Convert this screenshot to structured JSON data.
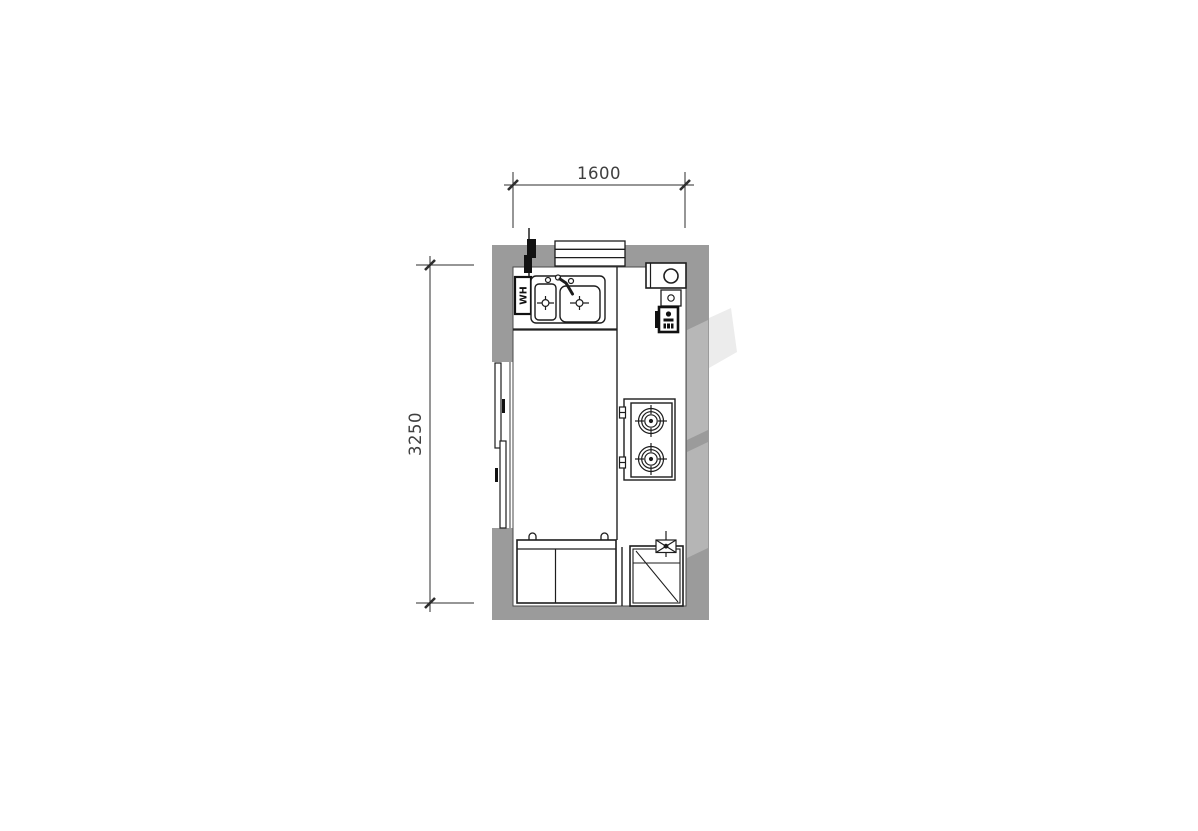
{
  "drawing": {
    "type": "kitchen-floor-plan",
    "dimensions": {
      "width_label": "1600",
      "height_label": "3250"
    },
    "labels": {
      "water_heater": "WH"
    },
    "colors": {
      "wall": "#9b9b9b",
      "line": "#1d1d1d",
      "dim_text": "#3f3f3f",
      "background": "#ffffff",
      "watermark_on_wall": "#b7b7b7",
      "watermark_on_white": "#ececec"
    },
    "fixtures": [
      {
        "name": "window",
        "location": "top-wall"
      },
      {
        "name": "gas-riser",
        "location": "top-left"
      },
      {
        "name": "water-heater",
        "label": "WH"
      },
      {
        "name": "double-bowl-sink",
        "location": "top-counter"
      },
      {
        "name": "faucet"
      },
      {
        "name": "flue-vent",
        "location": "top-right-corner"
      },
      {
        "name": "gas-meter"
      },
      {
        "name": "power-socket"
      },
      {
        "name": "gas-cooktop",
        "burners": 2,
        "location": "right-counter"
      },
      {
        "name": "sliding-door",
        "location": "left-wall"
      },
      {
        "name": "base-cabinet",
        "doors": 2,
        "location": "bottom-left"
      },
      {
        "name": "refrigerator",
        "location": "bottom-right"
      },
      {
        "name": "exhaust-fan",
        "location": "above-refrigerator"
      }
    ]
  }
}
